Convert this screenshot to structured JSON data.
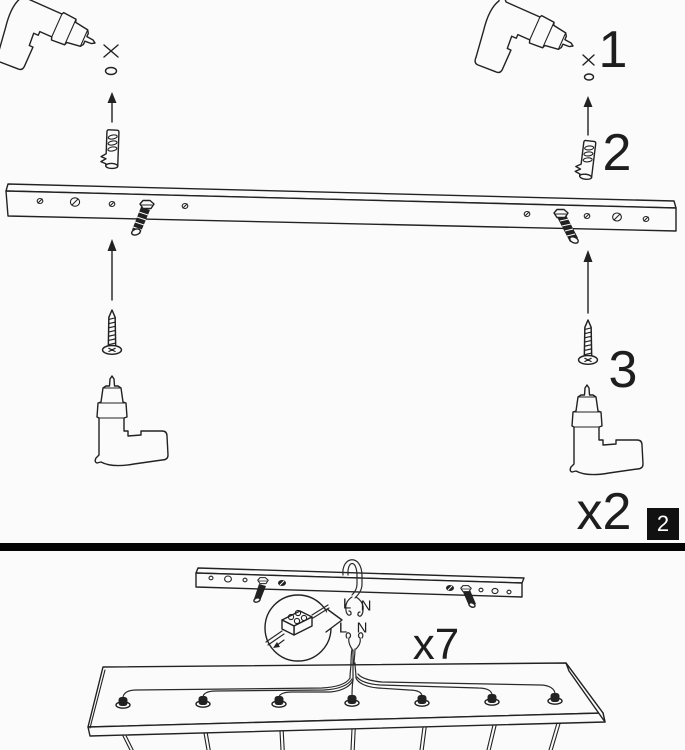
{
  "page": {
    "background_color": "#fbfbfb",
    "ink_color": "#222222",
    "divider_color": "#050505",
    "badge_color": "#111111"
  },
  "top_section": {
    "step_1_label": "1",
    "step_2_label": "2",
    "step_3_label": "3",
    "repeat_count_label": "x2",
    "page_number_badge": "2",
    "icons": [
      "drill-icon",
      "cross-mark-icon",
      "drill-hole-icon",
      "arrow-up-icon",
      "wall-plug-icon",
      "mounting-rail",
      "fixing-bolt-icon",
      "screw-icon"
    ]
  },
  "bottom_section": {
    "repeat_count_label": "x7",
    "terminal_labels": {
      "upper_live": "L",
      "upper_neutral": "N",
      "lower_live": "L",
      "lower_neutral": "N"
    },
    "icons": [
      "mounted-bracket",
      "detail-balloon",
      "terminal-block-icon",
      "cable-icon",
      "fixture-base",
      "cable-gland-icon",
      "pendant-cord-icon"
    ]
  }
}
